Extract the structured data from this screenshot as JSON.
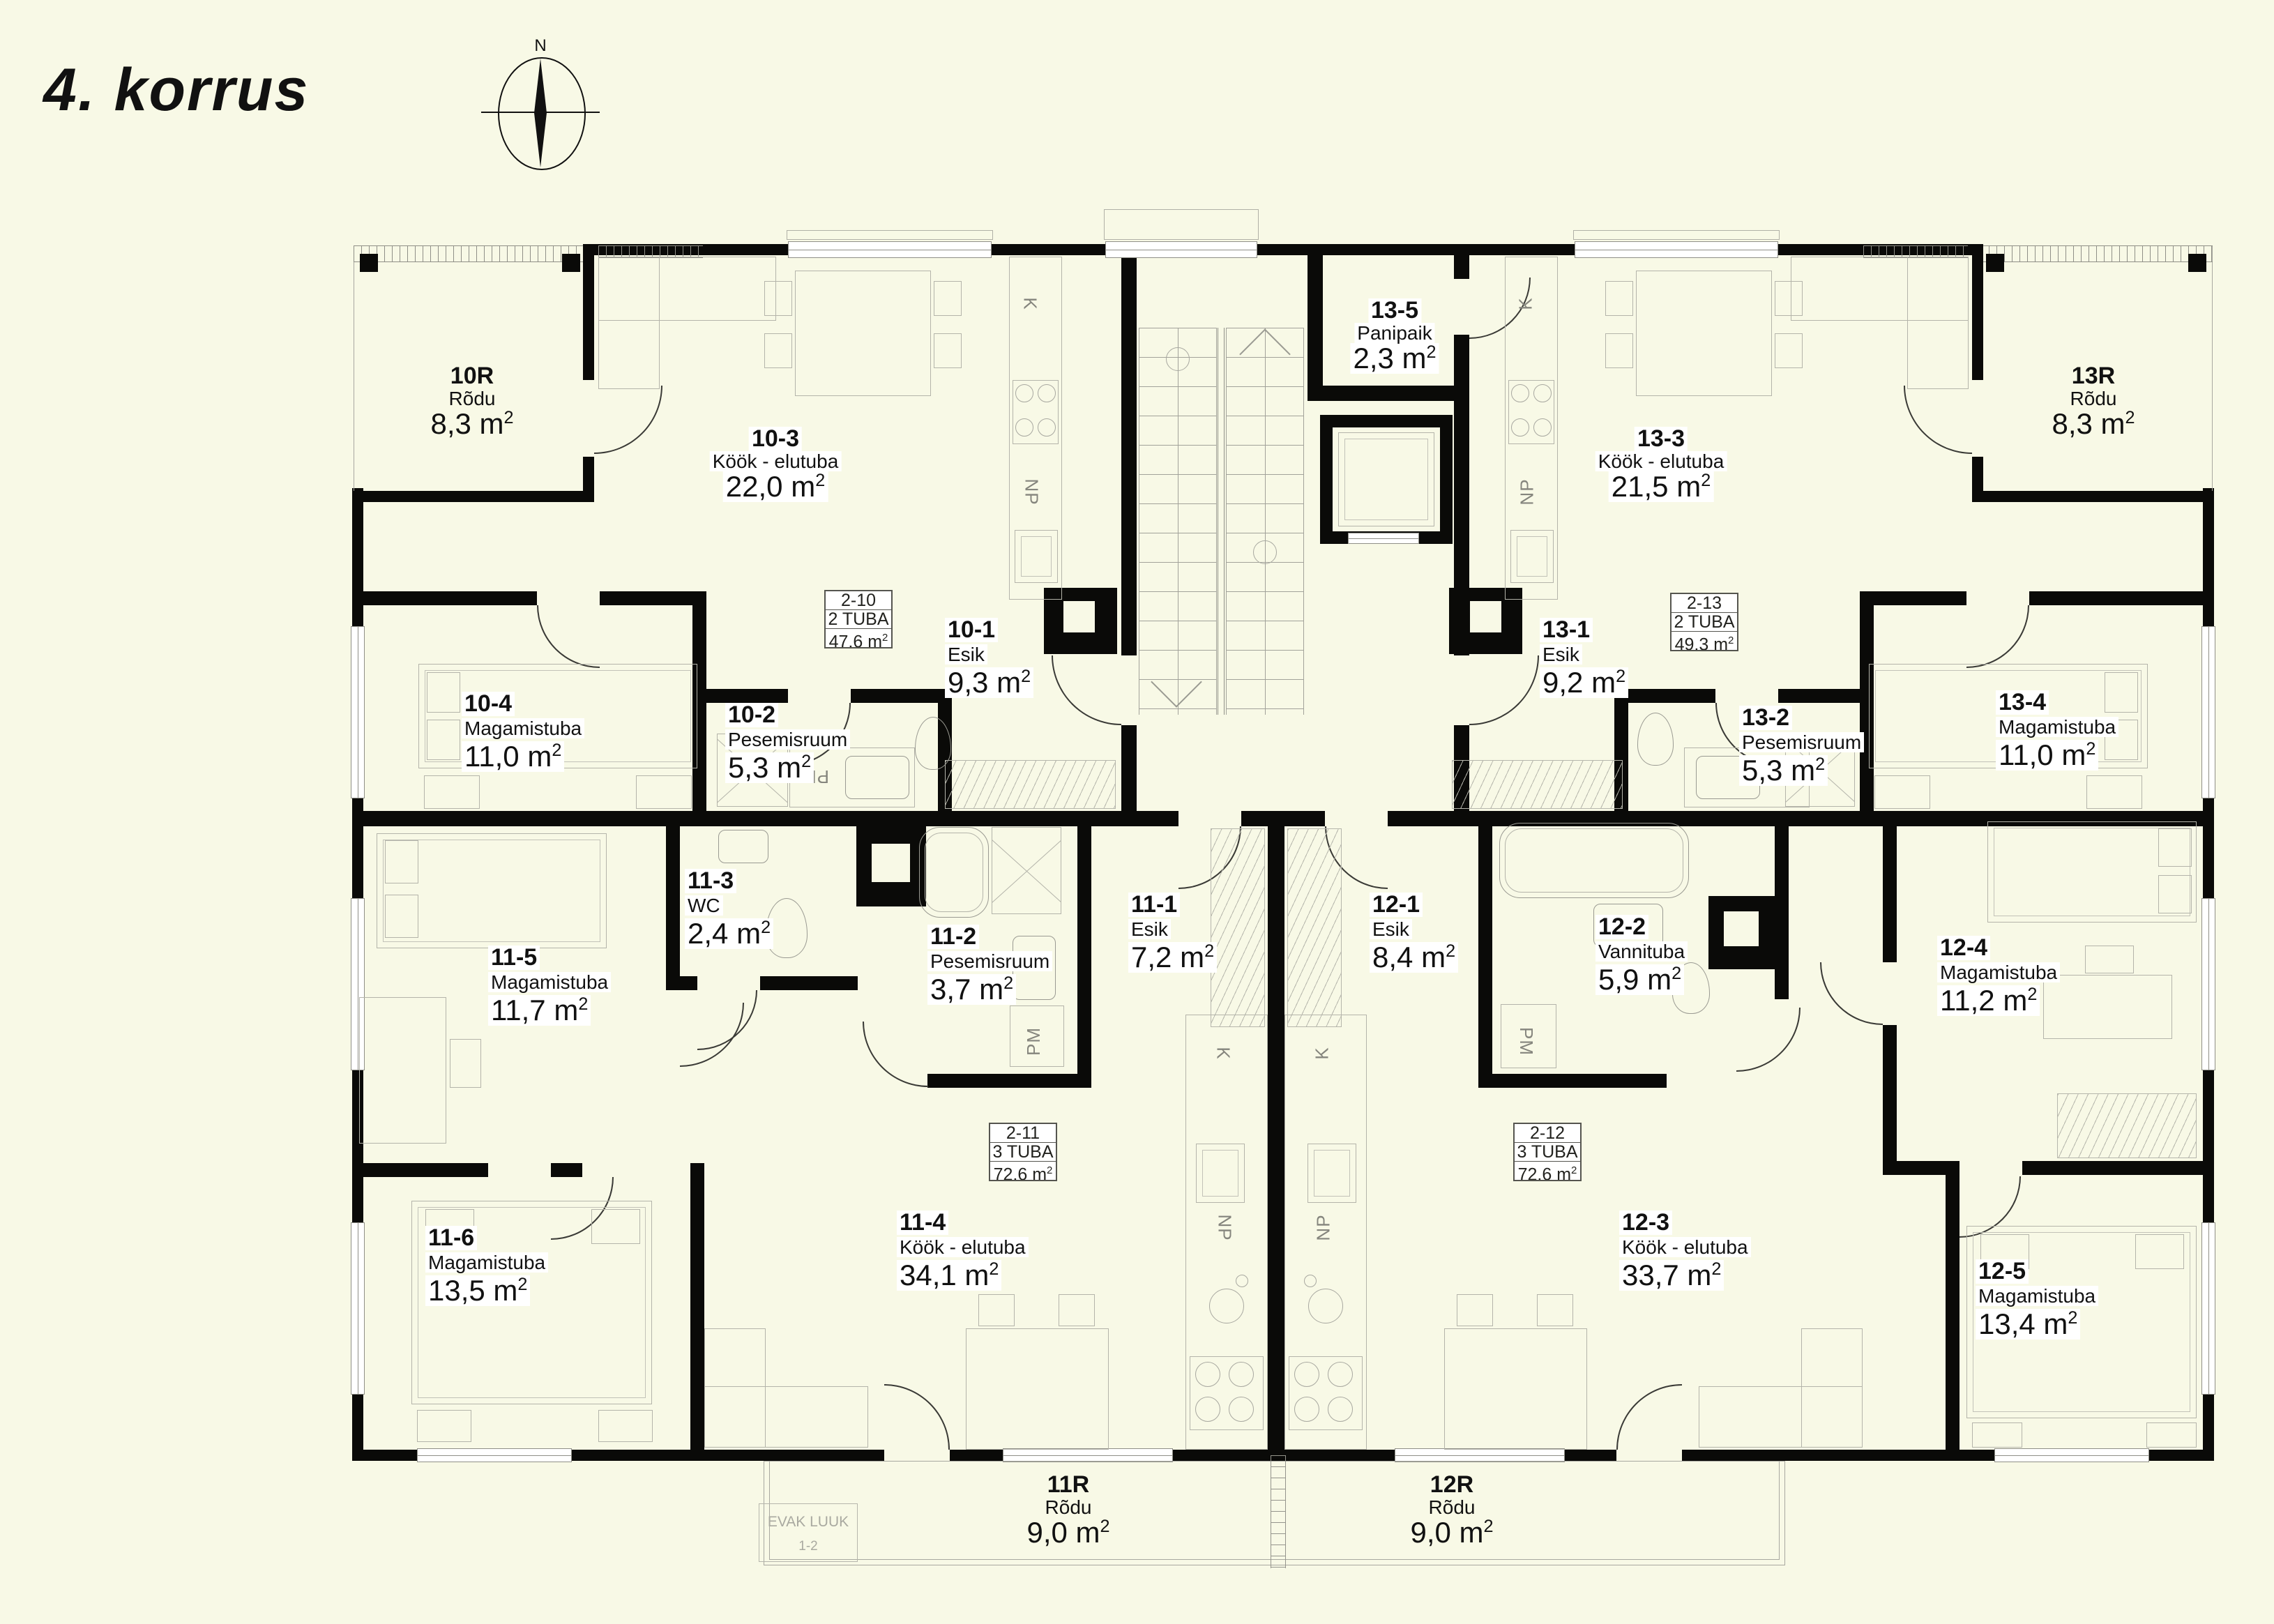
{
  "page": {
    "title": "4. korrus",
    "background": "#f8f9e6",
    "wall_color": "#0a0a08"
  },
  "compass": {
    "north_label": "N"
  },
  "units": {
    "area_suffix": "m",
    "area_sup": "2"
  },
  "unit_summaries": {
    "u2_10": {
      "code": "2-10",
      "rooms": "2 TUBA",
      "area": "47,6"
    },
    "u2_11": {
      "code": "2-11",
      "rooms": "3 TUBA",
      "area": "72,6"
    },
    "u2_12": {
      "code": "2-12",
      "rooms": "3 TUBA",
      "area": "72,6"
    },
    "u2_13": {
      "code": "2-13",
      "rooms": "2 TUBA",
      "area": "49,3"
    }
  },
  "rooms": {
    "r10r": {
      "code": "10R",
      "name": "Rõdu",
      "area": "8,3"
    },
    "r10_1": {
      "code": "10-1",
      "name": "Esik",
      "area": "9,3"
    },
    "r10_2": {
      "code": "10-2",
      "name": "Pesemisruum",
      "area": "5,3"
    },
    "r10_3": {
      "code": "10-3",
      "name": "Köök - elutuba",
      "area": "22,0"
    },
    "r10_4": {
      "code": "10-4",
      "name": "Magamistuba",
      "area": "11,0"
    },
    "r11r": {
      "code": "11R",
      "name": "Rõdu",
      "area": "9,0"
    },
    "r11_1": {
      "code": "11-1",
      "name": "Esik",
      "area": "7,2"
    },
    "r11_2": {
      "code": "11-2",
      "name": "Pesemisruum",
      "area": "3,7"
    },
    "r11_3": {
      "code": "11-3",
      "name": "WC",
      "area": "2,4"
    },
    "r11_4": {
      "code": "11-4",
      "name": "Köök - elutuba",
      "area": "34,1"
    },
    "r11_5": {
      "code": "11-5",
      "name": "Magamistuba",
      "area": "11,7"
    },
    "r11_6": {
      "code": "11-6",
      "name": "Magamistuba",
      "area": "13,5"
    },
    "r12r": {
      "code": "12R",
      "name": "Rõdu",
      "area": "9,0"
    },
    "r12_1": {
      "code": "12-1",
      "name": "Esik",
      "area": "8,4"
    },
    "r12_2": {
      "code": "12-2",
      "name": "Vannituba",
      "area": "5,9"
    },
    "r12_3": {
      "code": "12-3",
      "name": "Köök - elutuba",
      "area": "33,7"
    },
    "r12_4": {
      "code": "12-4",
      "name": "Magamistuba",
      "area": "11,2"
    },
    "r12_5": {
      "code": "12-5",
      "name": "Magamistuba",
      "area": "13,4"
    },
    "r13r": {
      "code": "13R",
      "name": "Rõdu",
      "area": "8,3"
    },
    "r13_1": {
      "code": "13-1",
      "name": "Esik",
      "area": "9,2"
    },
    "r13_2": {
      "code": "13-2",
      "name": "Pesemisruum",
      "area": "5,3"
    },
    "r13_3": {
      "code": "13-3",
      "name": "Köök - elutuba",
      "area": "21,5"
    },
    "r13_4": {
      "code": "13-4",
      "name": "Magamistuba",
      "area": "11,0"
    },
    "r13_5": {
      "code": "13-5",
      "name": "Panipaik",
      "area": "2,3"
    }
  },
  "appliances": {
    "fridge": "K",
    "dishwasher": "NP",
    "washer": "PM"
  },
  "evac": {
    "line1": "EVAK LUUK",
    "line2": "1-2"
  }
}
